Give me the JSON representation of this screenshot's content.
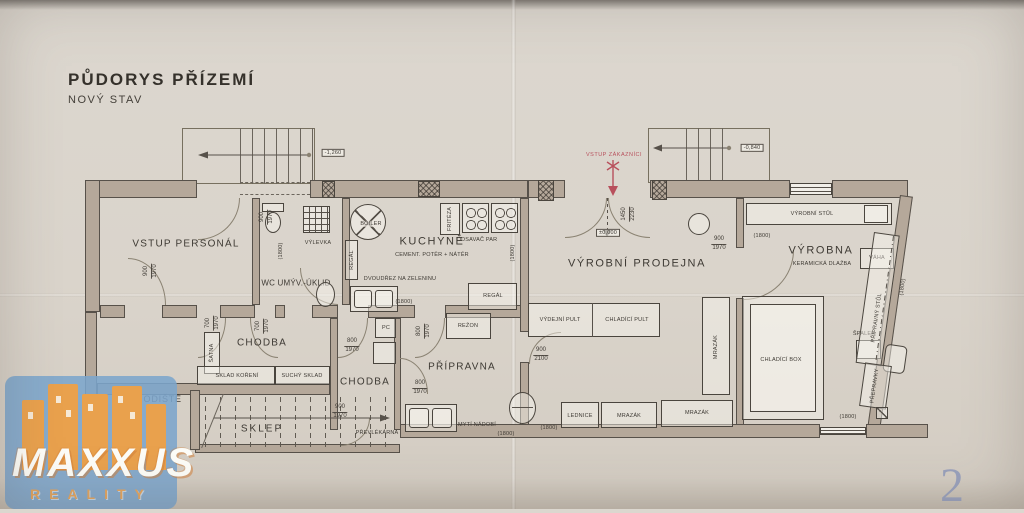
{
  "title": {
    "line1": "PŮDORYS PŘÍZEMÍ",
    "line2": "NOVÝ STAV"
  },
  "page_number": "2",
  "logo": {
    "name": "MAXXUS",
    "subtitle": "REALITY"
  },
  "entry": {
    "customers": "VSTUP ZÁKAZNÍCI"
  },
  "levels": {
    "zero": "±0,000",
    "stairs_left": "-1,260",
    "stairs_right": "-0,840"
  },
  "dims": {
    "d900_1970": {
      "top": "900",
      "bottom": "1970"
    },
    "d700_1970": {
      "top": "700",
      "bottom": "1970"
    },
    "d800_1970": {
      "top": "800",
      "bottom": "1970"
    },
    "d900_2100": {
      "top": "900",
      "bottom": "2100"
    },
    "d1450_2230": {
      "top": "1450",
      "bottom": "2230"
    },
    "p1800": "(1800)"
  },
  "rooms": {
    "vstup_personal": {
      "name": "VSTUP PERSONÁL"
    },
    "wc": {
      "name": "WC UMÝV.-ÚKLID",
      "vylevka": "VÝLEVKA"
    },
    "kuchyne": {
      "name": "KUCHYNĚ",
      "floor": "CEMENT. POTĚR + NÁTĚR",
      "boiler": "BOILER",
      "regal": "REGÁL",
      "friteza": "FRITÉZA",
      "odsavac": "ODSAVAČ PAR",
      "drez": "DVOUDŘEZ NA ZELENINU"
    },
    "vyrobni_prodejna": {
      "name": "VÝROBNÍ PRODEJNA",
      "vydejni_pult": "VÝDEJNÍ PULT",
      "chladici_pult": "CHLADÍCÍ PULT",
      "mrazak": "MRAZÁK",
      "lednice": "LEDNICE"
    },
    "vyrobna": {
      "name": "VÝROBNA",
      "floor": "KERAMICKÁ DLAŽBA",
      "vyrobni_stul": "VÝROBNÍ STŮL",
      "vaha": "VÁHA",
      "chladici_box": "CHLADÍCÍ BOX",
      "spalek": "ŠPALEK",
      "pripravny_stul": "PŘÍPRAVNÝ STŮL",
      "prepravky": "PŘEPRAVKY"
    },
    "chodba": {
      "name": "CHODBA",
      "satna": "ŠATNA",
      "sklad_koreni": "SKLAD KOŘENÍ",
      "suchy_sklad": "SUCHÝ SKLAD"
    },
    "chodba2": {
      "name": "CHODBA",
      "pc": "PC",
      "prevlekarna": "PŘEVLÉKÁRNA"
    },
    "pripravna": {
      "name": "PŘÍPRAVNA",
      "rezon": "REŽON",
      "myti": "MYTÍ NÁDOBÍ"
    },
    "schodiste": {
      "name": "SCHODIŠTĚ"
    },
    "sklep": {
      "name": "SKLEP"
    }
  }
}
